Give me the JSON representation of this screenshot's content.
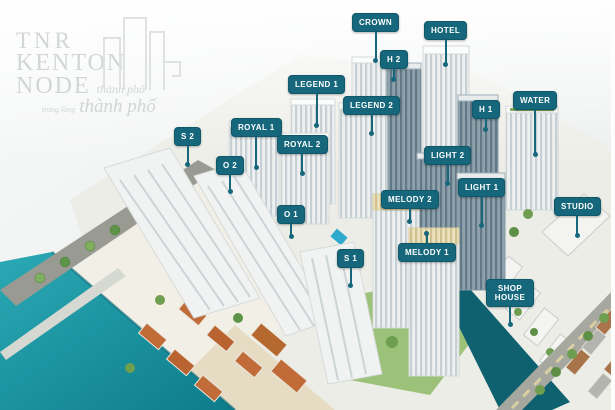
{
  "logo": {
    "brand_line1": "TNR",
    "brand_line2": "KENTON",
    "brand_line3": "NODE",
    "brand_line3_suffix": "thành phố",
    "tagline_small": "trong lòng",
    "tagline_large": "thành phố"
  },
  "palette": {
    "label_background": "#16677b",
    "label_text": "#ffffff",
    "river_water": "#1b9aa8",
    "canal_water": "#10616f",
    "vegetation": "#7fae5f",
    "building_white": "#f0f2f2",
    "building_glass": "#8fa1ab",
    "roof_orange": "#c06b38",
    "background": "#f2f4f4"
  },
  "labels": [
    {
      "id": "crown",
      "text": "CROWN"
    },
    {
      "id": "hotel",
      "text": "HOTEL"
    },
    {
      "id": "h2",
      "text": "H 2"
    },
    {
      "id": "legend-1",
      "text": "LEGEND 1"
    },
    {
      "id": "legend-2",
      "text": "LEGEND 2"
    },
    {
      "id": "h1",
      "text": "H 1"
    },
    {
      "id": "water",
      "text": "WATER"
    },
    {
      "id": "s2",
      "text": "S 2"
    },
    {
      "id": "royal-1",
      "text": "ROYAL 1"
    },
    {
      "id": "royal-2",
      "text": "ROYAL 2"
    },
    {
      "id": "o2",
      "text": "O 2"
    },
    {
      "id": "light-2",
      "text": "LIGHT 2"
    },
    {
      "id": "light-1",
      "text": "LIGHT 1"
    },
    {
      "id": "melody-2",
      "text": "MELODY 2"
    },
    {
      "id": "o1",
      "text": "O 1"
    },
    {
      "id": "melody-1",
      "text": "MELODY 1"
    },
    {
      "id": "s1",
      "text": "S 1"
    },
    {
      "id": "studio",
      "text": "STUDIO"
    },
    {
      "id": "shop-house",
      "text": "SHOP HOUSE"
    }
  ]
}
